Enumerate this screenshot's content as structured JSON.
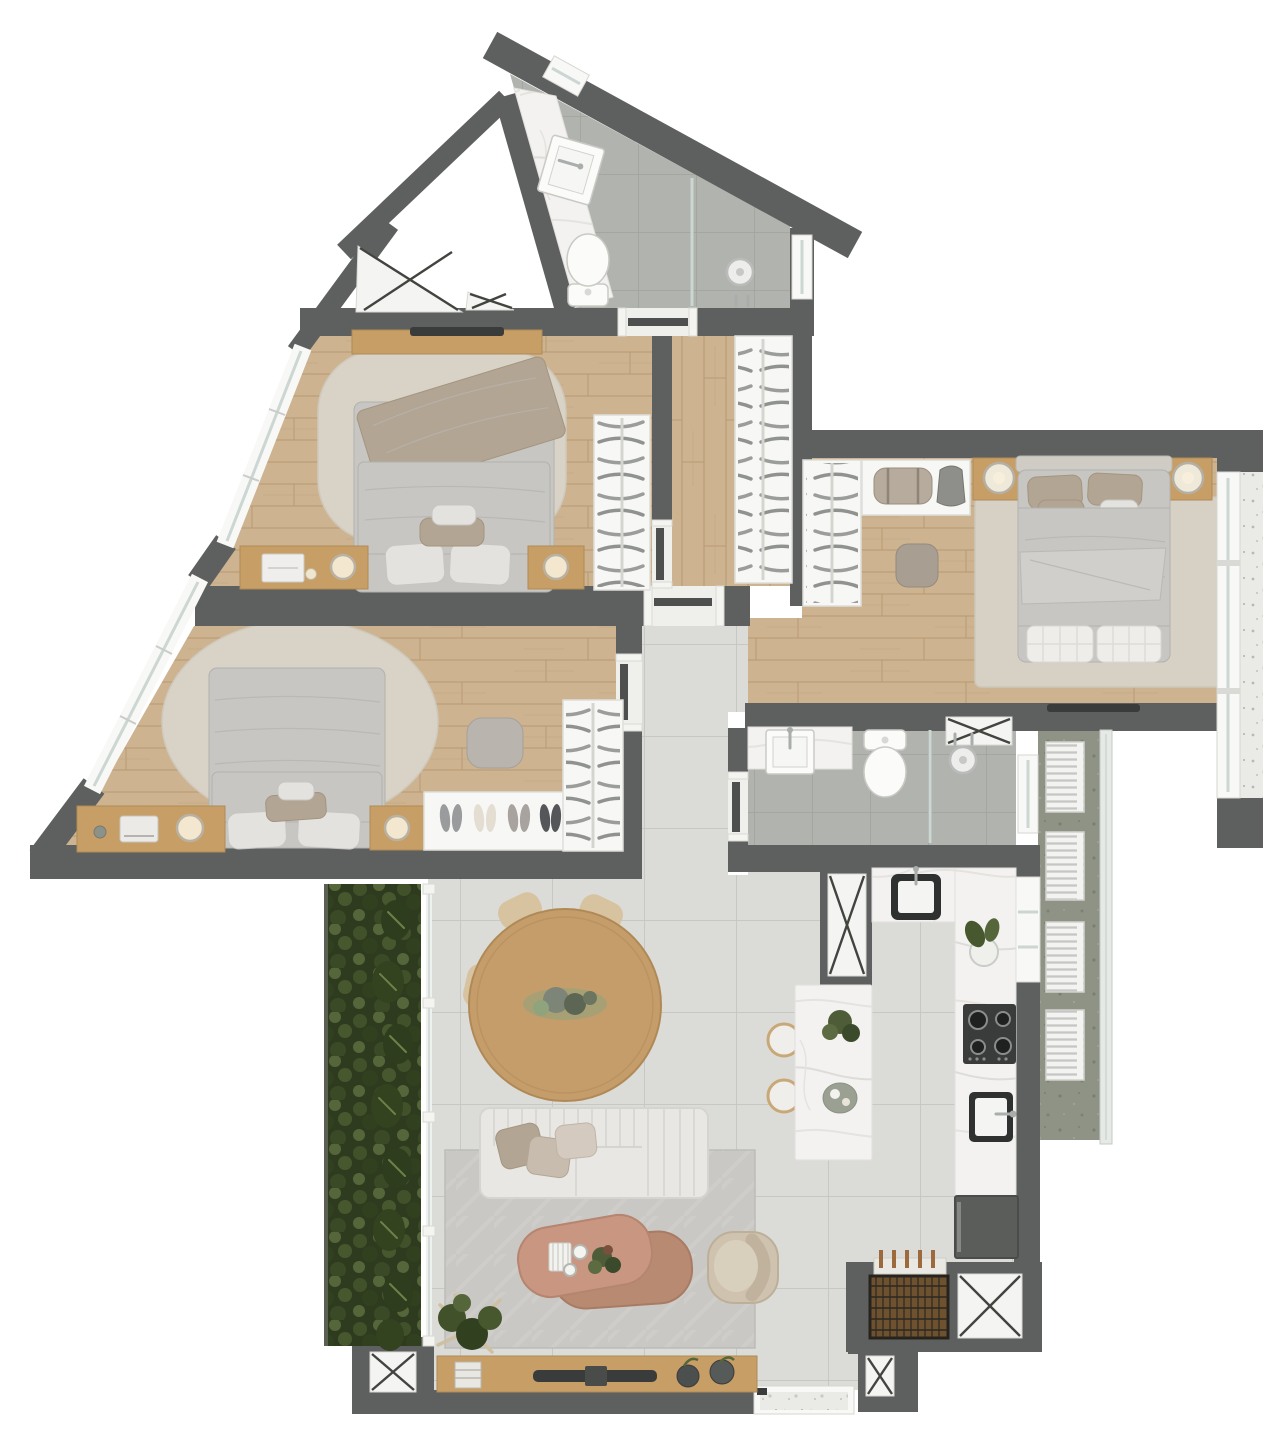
{
  "title": "apartment-floor-plan-render",
  "visible_text": [],
  "palette": {
    "wall": "#5e605f",
    "dark": "#3a3c3b",
    "white": "#f7f7f5",
    "glassLine": "#ccd6d2",
    "woodFurniture": "#c79e66",
    "duvet": "#c7c6c3",
    "pillow": "#e3e2df",
    "taupe": "#b3a593",
    "sofa": "#e8e7e3",
    "chair": "#d8c3a1",
    "chairEdge": "#c4a97f",
    "terracotta": "#c99681",
    "terracottaDeep": "#b98a72",
    "armchair": "#cfc2ae",
    "rugBeige": "#d9d3c7",
    "rugMaster": "#d6d1c4",
    "rugLiving": "#c9c8c4",
    "concrete": "#8e9386",
    "terrazzo": "#eaeae6",
    "chrome": "#a9adac",
    "glow": "#f3e8cf",
    "grillWood": "#6e5230",
    "bottleBrown": "#9c6a3d",
    "doorLeaf": "#4e504f",
    "hanger": "#8f928f",
    "shaftLine": "#42443f",
    "greenDark": "#2f3b1e",
    "green": "#41512a",
    "greenLight": "#55663a"
  },
  "rooms": [
    {
      "id": "bathroom-top",
      "type": "bathroom",
      "floor": "gray-tile",
      "features": [
        "angled-walls",
        "marble-vanity-counter",
        "basin",
        "toilet",
        "glass-shower-partition",
        "shower-head",
        "side-window",
        "wall-window"
      ]
    },
    {
      "id": "bedroom-1",
      "type": "bedroom",
      "floor": "wood",
      "features": [
        "double-bed",
        "throw-blanket",
        "rounded-rug",
        "wall-tv",
        "media-shelf",
        "desk-with-laptop",
        "table-lamps",
        "nightstand",
        "wardrobe-with-hangers",
        "diagonal-window"
      ]
    },
    {
      "id": "bedroom-2",
      "type": "bed room",
      "floor": "wood",
      "features": [
        "double-bed",
        "oval-rug",
        "vanity-desk",
        "glowing-lamps",
        "ottoman",
        "shoe-tray",
        "wardrobe-with-hangers",
        "diagonal-window"
      ]
    },
    {
      "id": "master-bedroom",
      "type": "bedroom",
      "floor": "wood",
      "features": [
        "double-bed",
        "headboard",
        "two-nightstands",
        "two-ball-lamps",
        "two-tufted-foot-benches",
        "area-rug",
        "ottoman",
        "closet-shelf",
        "duffel-bag",
        "backpack",
        "wardrobe-with-hangers",
        "wall-tv",
        "full-height-window",
        "terrazzo-ledge"
      ]
    },
    {
      "id": "hallway",
      "type": "circulation",
      "floor": "tile",
      "features": [
        "doors-to-bedrooms",
        "door-to-bathroom"
      ]
    },
    {
      "id": "corridor",
      "type": "circulation",
      "floor": "wood",
      "features": [
        "built-in-wardrobe"
      ]
    },
    {
      "id": "bathroom-middle",
      "type": "bathroom",
      "floor": "gray-tile",
      "features": [
        "marble-vanity-counter",
        "basin",
        "toilet",
        "glass-shower-partition",
        "shower-head",
        "duct-shaft",
        "window"
      ]
    },
    {
      "id": "service-balcony",
      "type": "balcony",
      "floor": "concrete",
      "features": [
        "four-condenser-units",
        "glass-railing"
      ]
    },
    {
      "id": "kitchen",
      "type": "kitchen",
      "floor": "tile",
      "features": [
        "marble-island",
        "two-bar-stools",
        "top-counter-sink",
        "gas-cooktop-4-burners",
        "second-sink",
        "refrigerator",
        "service-window",
        "duct-shaft",
        "potted-plant",
        "tray"
      ]
    },
    {
      "id": "dining-area",
      "type": "dining",
      "floor": "tile",
      "features": [
        "round-wood-table",
        "six-chairs",
        "green-centerpiece"
      ]
    },
    {
      "id": "living-area",
      "type": "living",
      "floor": "tile",
      "features": [
        "channel-tufted-sofa",
        "three-pillows",
        "two-nesting-coffee-tables",
        "decor-box",
        "cups",
        "plant-pot",
        "armchair",
        "herringbone-rug",
        "corner-plant",
        "wood-tv-console",
        "tv",
        "books",
        "two-vases",
        "floor-window"
      ]
    },
    {
      "id": "barbecue-corner",
      "type": "service",
      "floor": "wood-grate",
      "features": [
        "grill-grate",
        "bottle-row",
        "duct-shafts"
      ]
    },
    {
      "id": "vertical-garden",
      "type": "landscape",
      "features": [
        "dense-planting",
        "ferns",
        "glass-wall-with-posts",
        "planter-shaft"
      ]
    }
  ],
  "counts": {
    "bedrooms": 3,
    "bathrooms": 2,
    "wardrobes": 4,
    "ac_condenser_units": 4,
    "dining_chairs": 6,
    "shoe_pairs": 4,
    "duct_shafts": 7,
    "bar_stools": 2,
    "coffee_tables": 2,
    "foot_benches": 2,
    "beds": 3,
    "toilets": 2,
    "showers": 2,
    "sinks_kitchen": 2,
    "sinks_bath": 3
  }
}
